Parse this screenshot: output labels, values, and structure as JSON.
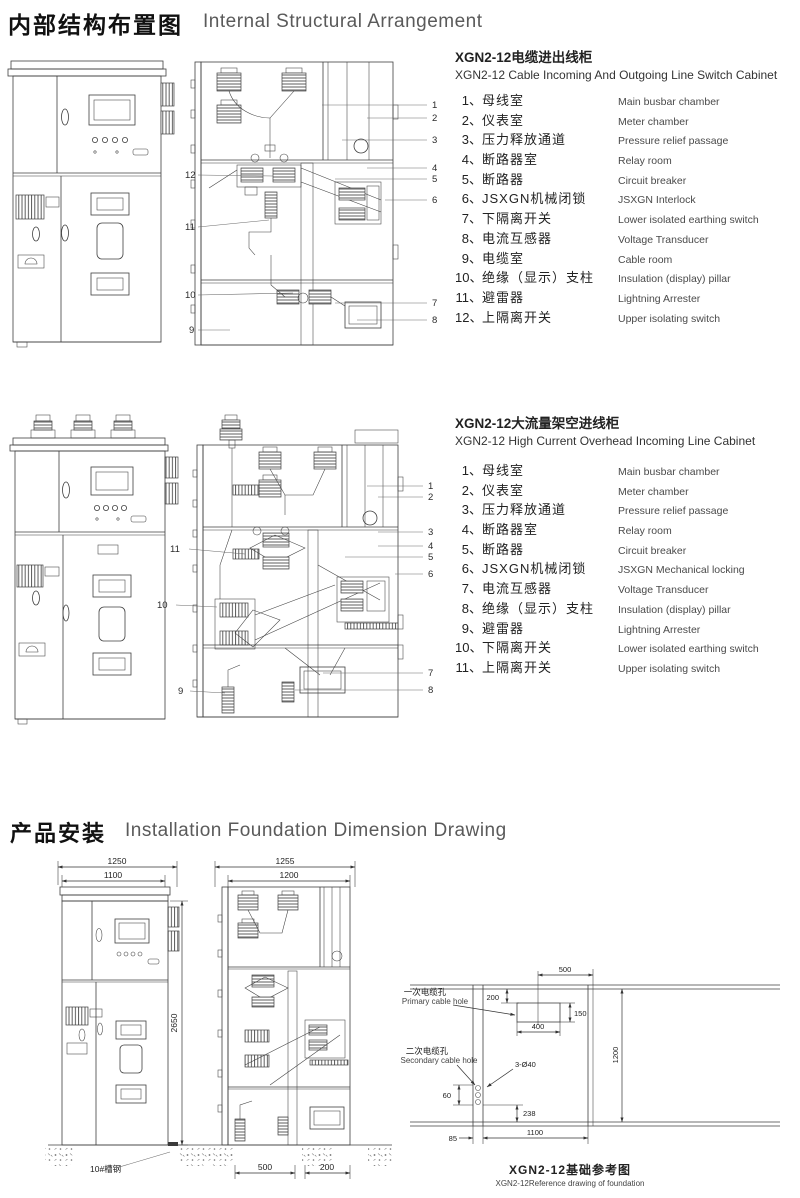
{
  "page_title": {
    "cn": "内部结构布置图",
    "en": "Internal Structural Arrangement"
  },
  "cabinet1": {
    "title_cn": "XGN2-12电缆进出线柜",
    "title_en": "XGN2-12 Cable Incoming And Outgoing Line Switch Cabinet",
    "items": [
      {
        "no": "1、",
        "cn": "母线室",
        "en": "Main busbar chamber"
      },
      {
        "no": "2、",
        "cn": "仪表室",
        "en": "Meter chamber"
      },
      {
        "no": "3、",
        "cn": "压力释放通道",
        "en": "Pressure relief passage"
      },
      {
        "no": "4、",
        "cn": "断路器室",
        "en": "Relay room"
      },
      {
        "no": "5、",
        "cn": "断路器",
        "en": "Circuit breaker"
      },
      {
        "no": "6、",
        "cn": "JSXGN机械闭锁",
        "en": "JSXGN Interlock"
      },
      {
        "no": "7、",
        "cn": "下隔离开关",
        "en": "Lower isolated earthing switch"
      },
      {
        "no": "8、",
        "cn": "电流互感器",
        "en": "Voltage Transducer"
      },
      {
        "no": "9、",
        "cn": "电缆室",
        "en": "Cable room"
      },
      {
        "no": "10、",
        "cn": "绝缘（显示）支柱",
        "en": "Insulation (display) pillar"
      },
      {
        "no": "11、",
        "cn": "避雷器",
        "en": "Lightning Arrester"
      },
      {
        "no": "12、",
        "cn": "上隔离开关",
        "en": "Upper isolating switch"
      }
    ],
    "callouts_right": [
      "1",
      "2",
      "3",
      "4",
      "5",
      "6",
      "7",
      "8"
    ],
    "callouts_left": [
      "12",
      "11",
      "10",
      "9"
    ]
  },
  "cabinet2": {
    "title_cn": "XGN2-12大流量架空进线柜",
    "title_en": "XGN2-12 High Current Overhead Incoming Line Cabinet",
    "items": [
      {
        "no": "1、",
        "cn": "母线室",
        "en": "Main busbar chamber"
      },
      {
        "no": "2、",
        "cn": "仪表室",
        "en": "Meter chamber"
      },
      {
        "no": "3、",
        "cn": "压力释放通道",
        "en": "Pressure relief passage"
      },
      {
        "no": "4、",
        "cn": "断路器室",
        "en": "Relay room"
      },
      {
        "no": "5、",
        "cn": "断路器",
        "en": "Circuit breaker"
      },
      {
        "no": "6、",
        "cn": "JSXGN机械闭锁",
        "en": "JSXGN Mechanical locking"
      },
      {
        "no": "7、",
        "cn": "电流互感器",
        "en": "Voltage Transducer"
      },
      {
        "no": "8、",
        "cn": "绝缘（显示）支柱",
        "en": "Insulation (display) pillar"
      },
      {
        "no": "9、",
        "cn": "避雷器",
        "en": "Lightning Arrester"
      },
      {
        "no": "10、",
        "cn": "下隔离开关",
        "en": "Lower isolated earthing switch"
      },
      {
        "no": "11、",
        "cn": "上隔离开关",
        "en": "Upper isolating switch"
      }
    ],
    "callouts_right": [
      "1",
      "2",
      "3",
      "4",
      "5",
      "6",
      "7",
      "8"
    ],
    "callouts_left": [
      "11",
      "10",
      "9"
    ]
  },
  "installation": {
    "title_cn": "产品安装",
    "title_en": "Installation Foundation Dimension Drawing",
    "front_view": {
      "width_outer": "1250",
      "width_inner": "1100",
      "height": "2650",
      "channel": "10#槽钢"
    },
    "section_view": {
      "width_outer": "1255",
      "width_inner": "1200",
      "trench_front": "500",
      "trench_rear": "200"
    },
    "foundation": {
      "top_width": "500",
      "top_offset": "200",
      "hole_height": "150",
      "hole_width": "400",
      "depth": "1200",
      "holes": "3-Ø40",
      "sec_height": "60",
      "rear_offset": "238",
      "front_gap": "85",
      "width": "1100",
      "primary_cn": "一次电缆孔",
      "primary_en": "Primary cable hole",
      "secondary_cn": "二次电缆孔",
      "secondary_en": "Secondary cable hole",
      "caption_cn": "XGN2-12基础参考图",
      "caption_en": "XGN2-12Reference drawing of foundation"
    }
  }
}
